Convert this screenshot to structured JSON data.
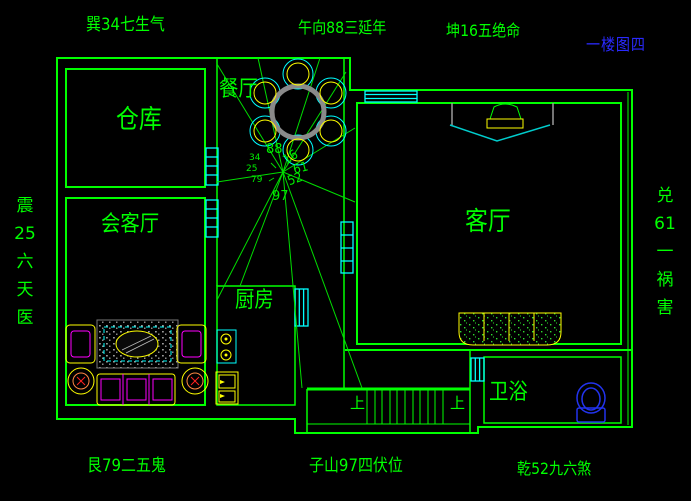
{
  "annotations": {
    "top_left": "巽34七生气",
    "top_center": "午向88三延年",
    "top_right": "坤16五绝命",
    "sheet": "一楼图四",
    "left_vertical": "震\n25\n六\n天\n医",
    "right_vertical": "兑\n61\n一\n祸\n害",
    "bottom_left": "艮79二五鬼",
    "bottom_center": "子山97四伏位",
    "bottom_right": "乾52九六煞"
  },
  "rooms": {
    "storage": "仓库",
    "dining": "餐厅",
    "reception": "会客厅",
    "living": "客厅",
    "kitchen": "厨房",
    "bathroom": "卫浴"
  },
  "stairs": {
    "up_label_left": "上",
    "up_label_right": "上"
  },
  "compass": {
    "n88": "88",
    "n16": "16",
    "n61": "61",
    "n52": "52",
    "n97": "97",
    "n34": "34",
    "n25": "25",
    "n79": "79"
  },
  "colors": {
    "background": "#000000",
    "wall_green": "#00ff00",
    "window_cyan": "#00ffff",
    "furniture_yellow": "#ffff00",
    "furniture_magenta": "#ff00ff",
    "table_gray": "#8a8a8a",
    "toilet_blue": "#2233ee",
    "sheet_label_blue": "#2a2aff",
    "accent_red": "#ff2222"
  }
}
